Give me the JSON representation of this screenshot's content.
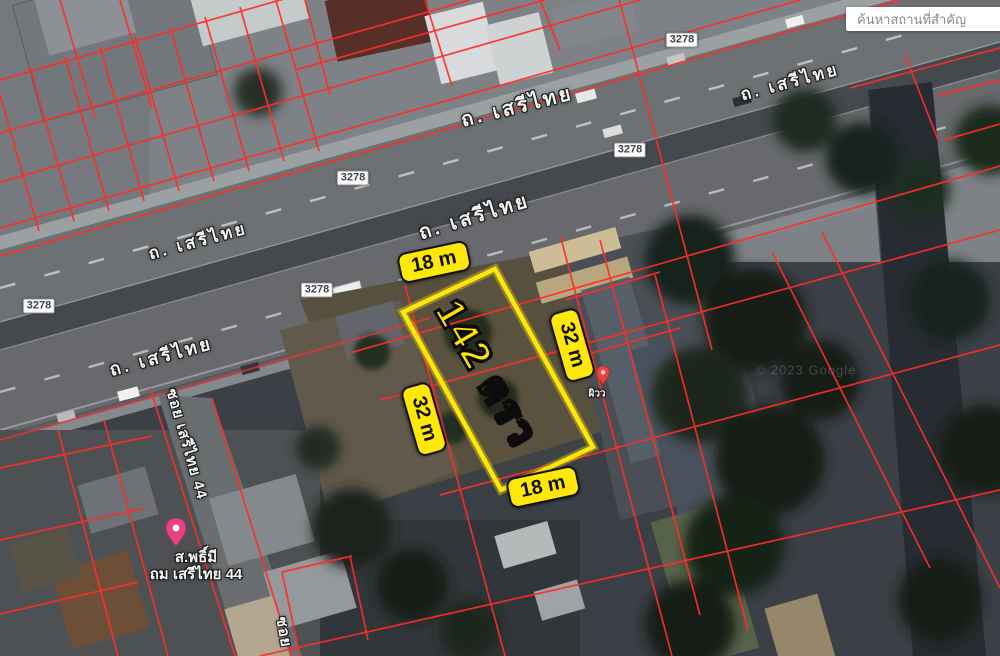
{
  "search": {
    "placeholder": "ค้นหาสถานที่สำคัญ"
  },
  "map": {
    "road_name": "ถ. เสรีไทย",
    "route_number": "3278",
    "soi_label": "ซอย เสรีไทย 44",
    "soi_partial": "ซอย",
    "poi": {
      "line1": "ส.พธิ์มี",
      "line2": "ถม เสรีไทย 44"
    },
    "small_poi": "ผิวว",
    "watermark": "© 2023 Google",
    "parcel_line_color": "#ff2d27",
    "poi_pin_color": "#e5447e",
    "small_pin_color": "#e8453c"
  },
  "plot": {
    "area_label": "142 ตรว",
    "width_label": "18 m",
    "depth_label": "32 m",
    "outline_color": "#ffe70a"
  }
}
